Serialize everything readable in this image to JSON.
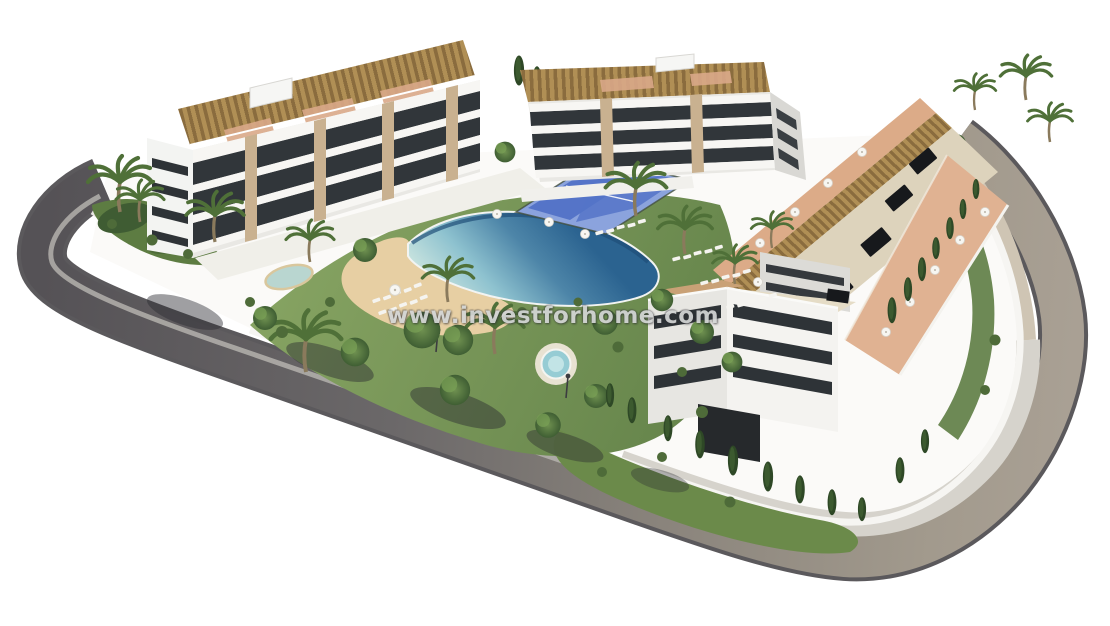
{
  "meta": {
    "type": "3d-architectural-render",
    "description": "Aerial 3D render of a modern white apartment complex with communal infinity pool, beach-style lagoon, spa, paddle courts, gardens and a perimeter road"
  },
  "watermark": {
    "text": "www.investforhome.com"
  },
  "palette": {
    "background": "#ffffff",
    "road_dark": "#555256",
    "road_mid": "#6b6869",
    "road_light": "#a29a8d",
    "road_edge": "#3e3c40",
    "sidewalk": "#d6d3cc",
    "walkway_tan": "#cfc5b4",
    "curb": "#b9b6b1",
    "plot": "#fbfaf8",
    "wall_white": "#f6f5f2",
    "building_lit": "#f4f3f0",
    "building_shade": "#e7e6e2",
    "window_dark": "#2e3337",
    "stone_pillar": "#c9b190",
    "pergola": "#b08f55",
    "pergola_slat": "#8a6c3e",
    "roof_beige": "#ddd3bc",
    "terrace_terracotta": "#dcab88",
    "pool_deep": "#2b6390",
    "pool_mid": "#4d85a8",
    "pool_pale": "#c6e2de",
    "spa_water": "#96ccd4",
    "sand": "#e7cfa3",
    "lawn_light": "#86a362",
    "lawn_dark": "#64834a",
    "tree_green": "#3f5e33",
    "cypress_green": "#2e4826",
    "court_blue": "#5574c8",
    "court_border": "#8ba3dd",
    "pond": "#b9d6d0",
    "skylight": "#17191c",
    "shadow": "#2a2a30"
  }
}
